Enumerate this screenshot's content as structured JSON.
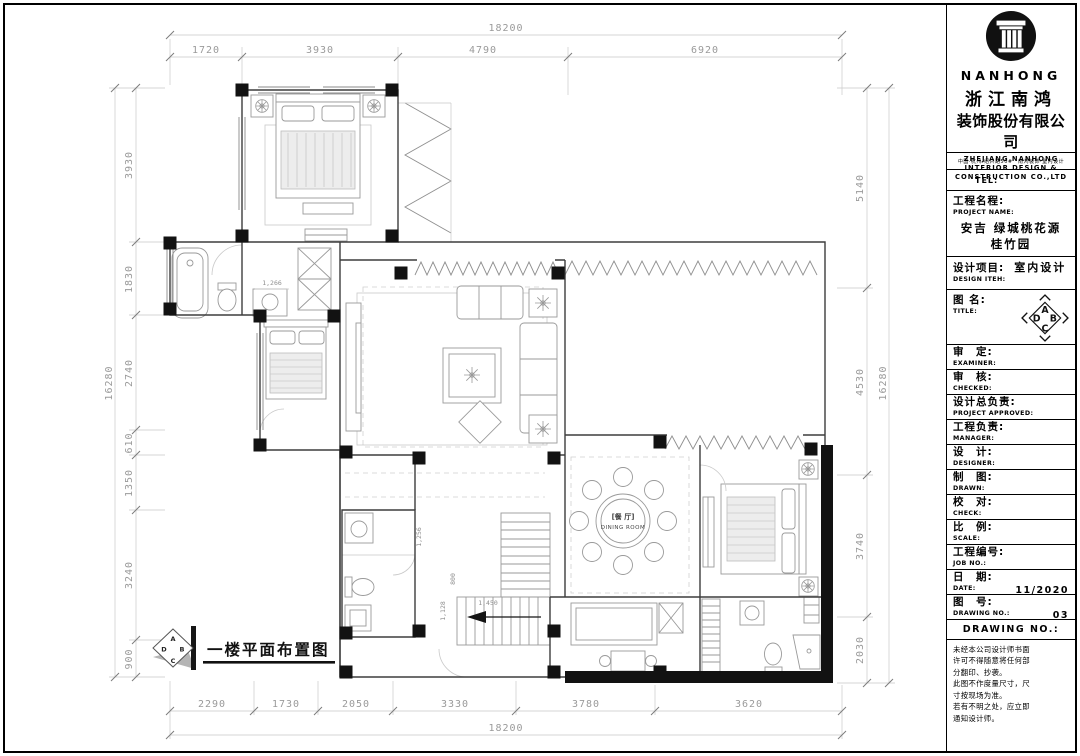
{
  "title_block": {
    "brand": "NANHONG",
    "company_cn_line1": "浙江南鸿",
    "company_cn_line2": "装饰股份有限公司",
    "company_en_line1": "ZHEJIANG NANHONG",
    "company_en_line2": "INTERIOR DESIGN &",
    "company_en_line3": "CONSTRUCTION CO.,LTD",
    "address": "中国·杭州·绍兴路50#　南鸿装饰·室内设计",
    "tel_label": "TEL:",
    "project": {
      "cn": "工程名程:",
      "en": "PROJECT NAME:",
      "value_line1": "安吉 绿城桃花源",
      "value_line2": "桂竹园"
    },
    "design_item": {
      "cn": "设计项目:",
      "value": "室内设计",
      "en": "DESIGN ITEH:"
    },
    "title_field": {
      "cn": "图 名:",
      "en": "TITLE:"
    },
    "rows": {
      "examiner": {
        "cn": "审　定:",
        "en": "EXAMINER:"
      },
      "checked": {
        "cn": "审　核:",
        "en": "CHECKED:"
      },
      "approved": {
        "cn": "设计总负责:",
        "en": "PROJECT APPROVED:"
      },
      "manager": {
        "cn": "工程负责:",
        "en": "MANAGER:"
      },
      "designer": {
        "cn": "设　计:",
        "en": "DESIGNER:"
      },
      "drawn": {
        "cn": "制　图:",
        "en": "DRAWN:"
      },
      "check": {
        "cn": "校　对:",
        "en": "CHECK:"
      },
      "scale": {
        "cn": "比　例:",
        "en": "SCALE:"
      },
      "job_no": {
        "cn": "工程编号:",
        "en": "JOB NO.:"
      },
      "date": {
        "cn": "日　期:",
        "en": "DATE:",
        "value": "11/2020"
      },
      "drawing_no": {
        "cn": "图　号:",
        "en": "DRAWING NO.:",
        "value": "03"
      }
    },
    "drawing_no_header": "DRAWING NO.:",
    "notes": [
      "未经本公司设计师书面",
      "许可不得随意将任何部",
      "分翻印、抄袭。",
      "此图不作度量尺寸，尺",
      "寸按现场为准。",
      "若有不明之处，应立即",
      "通知设计师。"
    ]
  },
  "plan": {
    "title": "一楼平面布置图",
    "dining_label_cn": "[餐 厅]",
    "dining_label_en": "DINING ROOM",
    "compass": {
      "n": "A",
      "e": "B",
      "s": "C",
      "w": "D"
    },
    "inner_dims": {
      "bath": "1,266",
      "stair_width": "1,450",
      "stair_left": "1,128",
      "wc": "800",
      "closet": "1,256"
    }
  },
  "dims": {
    "top": {
      "overall": "18200",
      "segments": [
        "1720",
        "3930",
        "4790",
        "6920"
      ]
    },
    "bottom": {
      "overall": "18200",
      "segments": [
        "2290",
        "1730",
        "2050",
        "3330",
        "3780",
        "3620"
      ]
    },
    "left": {
      "overall": "16280",
      "segments": [
        "3930",
        "1830",
        "2740",
        "610",
        "1350",
        "3240",
        "900"
      ]
    },
    "right": {
      "overall": "16280",
      "segments": [
        "5140",
        "4530",
        "3740",
        "2030"
      ]
    }
  }
}
